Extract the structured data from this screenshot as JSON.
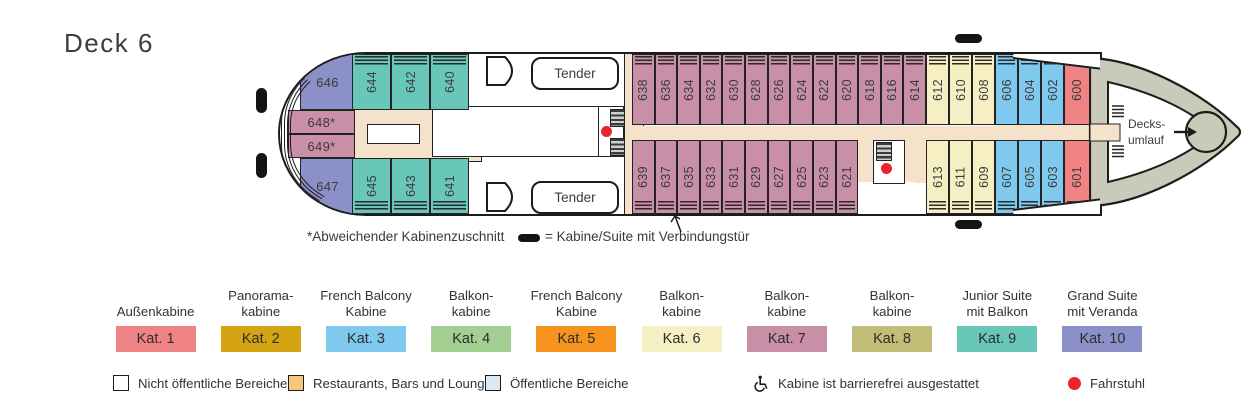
{
  "page": {
    "title": "Deck 6"
  },
  "ship": {
    "tender_label": "Tender",
    "stern_line1": "Decks-",
    "stern_line2": "umlauf",
    "bow_cabins": [
      {
        "number": "646",
        "cat": 10
      },
      {
        "number": "648*",
        "cat": 7
      },
      {
        "number": "649*",
        "cat": 7
      },
      {
        "number": "647",
        "cat": 10
      }
    ],
    "top_row": [
      {
        "number": "644",
        "cat": 9
      },
      {
        "number": "642",
        "cat": 9
      },
      {
        "number": "640",
        "cat": 9
      },
      {
        "number": "638",
        "cat": 7
      },
      {
        "number": "636",
        "cat": 7
      },
      {
        "number": "634",
        "cat": 7
      },
      {
        "number": "632",
        "cat": 7
      },
      {
        "number": "630",
        "cat": 7
      },
      {
        "number": "628",
        "cat": 7
      },
      {
        "number": "626",
        "cat": 7
      },
      {
        "number": "624",
        "cat": 7
      },
      {
        "number": "622",
        "cat": 7
      },
      {
        "number": "620",
        "cat": 7
      },
      {
        "number": "618",
        "cat": 7
      },
      {
        "number": "616",
        "cat": 7
      },
      {
        "number": "614",
        "cat": 7
      },
      {
        "number": "612",
        "cat": 6
      },
      {
        "number": "610",
        "cat": 6
      },
      {
        "number": "608",
        "cat": 6
      },
      {
        "number": "606",
        "cat": 3
      },
      {
        "number": "604",
        "cat": 3
      },
      {
        "number": "602",
        "cat": 3
      },
      {
        "number": "600",
        "cat": 1
      }
    ],
    "bottom_row": [
      {
        "number": "645",
        "cat": 9
      },
      {
        "number": "643",
        "cat": 9
      },
      {
        "number": "641",
        "cat": 9
      },
      {
        "number": "639",
        "cat": 7
      },
      {
        "number": "637",
        "cat": 7
      },
      {
        "number": "635",
        "cat": 7
      },
      {
        "number": "633",
        "cat": 7
      },
      {
        "number": "631",
        "cat": 7
      },
      {
        "number": "629",
        "cat": 7
      },
      {
        "number": "627",
        "cat": 7
      },
      {
        "number": "625",
        "cat": 7
      },
      {
        "number": "623",
        "cat": 7
      },
      {
        "number": "621",
        "cat": 7
      },
      {
        "number": "613",
        "cat": 6
      },
      {
        "number": "611",
        "cat": 6
      },
      {
        "number": "609",
        "cat": 6
      },
      {
        "number": "607",
        "cat": 3
      },
      {
        "number": "605",
        "cat": 3
      },
      {
        "number": "603",
        "cat": 3
      },
      {
        "number": "601",
        "cat": 1
      }
    ]
  },
  "notes": {
    "asterisk_note": "*Abweichender Kabinenzuschnitt",
    "connecting_door_note": "= Kabine/Suite mit Verbindungstür"
  },
  "categories": [
    {
      "line1": "Außenkabine",
      "line2": "",
      "badge": "Kat. 1",
      "color": "#F08384"
    },
    {
      "line1": "Panorama-",
      "line2": "kabine",
      "badge": "Kat. 2",
      "color": "#D5A413"
    },
    {
      "line1": "French Balcony",
      "line2": "Kabine",
      "badge": "Kat. 3",
      "color": "#7FC9EE"
    },
    {
      "line1": "Balkon-",
      "line2": "kabine",
      "badge": "Kat. 4",
      "color": "#A4CF92"
    },
    {
      "line1": "French Balcony",
      "line2": "Kabine",
      "badge": "Kat. 5",
      "color": "#F6921E"
    },
    {
      "line1": "Balkon-",
      "line2": "kabine",
      "badge": "Kat. 6",
      "color": "#F6EFC3"
    },
    {
      "line1": "Balkon-",
      "line2": "kabine",
      "badge": "Kat. 7",
      "color": "#C98FA6"
    },
    {
      "line1": "Balkon-",
      "line2": "kabine",
      "badge": "Kat. 8",
      "color": "#C2BD77"
    },
    {
      "line1": "Junior Suite",
      "line2": "mit Balkon",
      "badge": "Kat. 9",
      "color": "#68C7B9"
    },
    {
      "line1": "Grand Suite",
      "line2": "mit Veranda",
      "badge": "Kat. 10",
      "color": "#8C90C8"
    }
  ],
  "area_legend": [
    {
      "type": "outline",
      "color": "#FFFFFF",
      "label": "Nicht öffentliche Bereiche"
    },
    {
      "type": "fill",
      "color": "#F6C87E",
      "label": "Restaurants, Bars und Lounges"
    },
    {
      "type": "fill",
      "color": "#DBE9F5",
      "label": "Öffentliche Bereiche"
    },
    {
      "type": "wheelchair",
      "color": "#1c1c1c",
      "label": "Kabine ist barrierefrei ausgestattet"
    },
    {
      "type": "dot",
      "color": "#E8252D",
      "label": "Fahrstuhl"
    }
  ],
  "markers": {
    "elevator_color": "#E8252D",
    "corridor_color": "#F4E3CA",
    "hull_gray": "#CACAB9"
  }
}
